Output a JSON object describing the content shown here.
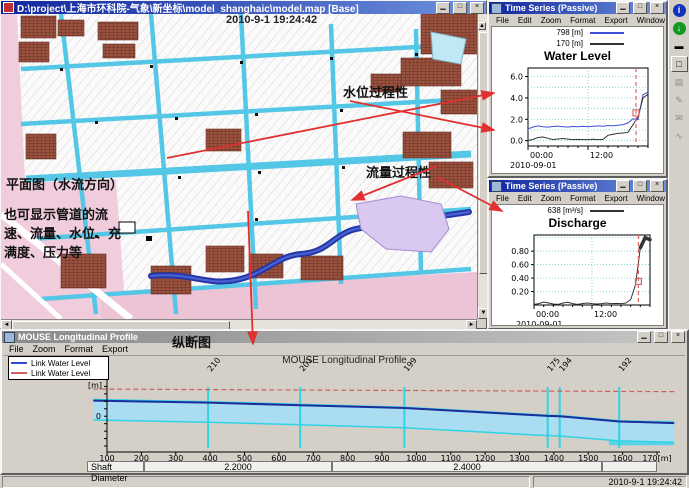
{
  "icons": {
    "minimize": "▁",
    "maximize": "□",
    "close": "×",
    "scroll_left": "◄",
    "scroll_right": "►",
    "scroll_up": "▲",
    "scroll_down": "▼",
    "info": "i",
    "ok": "↓",
    "dash": "▬",
    "window": "□",
    "page": "▤",
    "edit": "✎",
    "chat": "✉",
    "chart": "∿"
  },
  "map_window": {
    "title": "D:\\project\\上海市环科院-气象\\新坐标\\model_shanghaic\\model.map [Base]"
  },
  "overlay": {
    "timestamp": "2010-9-1 19:24:42",
    "water_level_label": "水位过程性",
    "discharge_label": "流量过程性",
    "plan_label": "平面图（水流方向）",
    "plan_note": "也可显示管道的流速、流量、水位、充满度、压力等",
    "profile_label": "纵断图"
  },
  "ts1": {
    "title": "Time Series (Passive)",
    "menu": [
      "File",
      "Edit",
      "Zoom",
      "Format",
      "Export",
      "Window"
    ]
  },
  "ts2": {
    "title": "Time Series (Passive)",
    "menu": [
      "File",
      "Edit",
      "Zoom",
      "Format",
      "Export",
      "Window"
    ]
  },
  "profile_window": {
    "title": "MOUSE Longitudinal Profile",
    "menu": [
      "File",
      "Zoom",
      "Format",
      "Export"
    ]
  },
  "status_bar": {
    "timestamp": "2010-9-1 19:24:42"
  },
  "chart_data": [
    {
      "id": "water_level",
      "type": "line",
      "title": "Water Level",
      "xlim": [
        0,
        24
      ],
      "ylim": [
        -0.5,
        6.8
      ],
      "x": [
        0,
        1,
        2,
        3,
        4,
        5,
        6,
        7,
        8,
        9,
        10,
        11,
        12,
        13,
        14,
        15,
        16,
        17,
        18,
        19,
        20,
        21,
        22,
        23,
        24
      ],
      "yticks": [
        0,
        2,
        4,
        6
      ],
      "ytick_labels": [
        "0.0",
        "2.0",
        "4.0",
        "6.0"
      ],
      "grid_y": [
        0,
        1,
        2,
        3,
        4,
        5,
        6
      ],
      "xticks": [
        0,
        12
      ],
      "xtick_labels": [
        "00:00",
        "12:00"
      ],
      "date_label": "2010-09-01",
      "series": [
        {
          "name": "798 [m]",
          "color": "#3b4fd8",
          "values": [
            1.1,
            1.28,
            1.38,
            1.3,
            1.27,
            1.33,
            1.36,
            1.3,
            1.28,
            1.32,
            1.3,
            1.34,
            1.3,
            1.35,
            1.38,
            1.35,
            1.42,
            1.38,
            1.44,
            1.5,
            1.65,
            2.05,
            1.95,
            4.3,
            4.55
          ]
        },
        {
          "name": "170 [m]",
          "color": "#333333",
          "values": [
            0.0,
            0.12,
            0.3,
            0.34,
            0.22,
            0.1,
            0.15,
            0.2,
            0.14,
            0.1,
            0.12,
            0.1,
            0.1,
            0.13,
            0.1,
            0.12,
            0.5,
            0.6,
            0.68,
            0.72,
            0.78,
            1.5,
            2.2,
            4.0,
            4.35
          ]
        }
      ],
      "cursor": {
        "x": 21.6,
        "marker_y": 2.6,
        "color": "#e06666"
      },
      "legend_position": "top"
    },
    {
      "id": "discharge",
      "type": "line",
      "title": "Discharge",
      "xlim": [
        0,
        24
      ],
      "ylim": [
        0,
        1.04
      ],
      "x": [
        0,
        1,
        2,
        3,
        4,
        5,
        6,
        7,
        8,
        9,
        10,
        11,
        12,
        13,
        14,
        15,
        16,
        17,
        18,
        19,
        20,
        21,
        22,
        23,
        24
      ],
      "yticks": [
        0.2,
        0.4,
        0.6,
        0.8
      ],
      "ytick_labels": [
        "0.20",
        "0.40",
        "0.60",
        "0.80"
      ],
      "grid_y": [
        0.2,
        0.4,
        0.6,
        0.8,
        1.0
      ],
      "xticks": [
        0,
        12
      ],
      "xtick_labels": [
        "00:00",
        "12:00"
      ],
      "date_label": "2010-09-01",
      "series": [
        {
          "name": "638 [m³/s]",
          "color": "#333333",
          "thick_from": 21.5,
          "values": [
            0.01,
            0.02,
            0.045,
            0.03,
            0.015,
            0.01,
            0.03,
            0.04,
            0.02,
            0.01,
            0.02,
            0.03,
            0.02,
            0.015,
            0.02,
            0.03,
            0.02,
            0.025,
            0.02,
            0.03,
            0.08,
            0.3,
            0.85,
            1.0,
            0.97
          ]
        }
      ],
      "cursor": {
        "x": 21.6,
        "marker_y": 0.35,
        "color": "#e06666"
      },
      "legend_position": "top"
    },
    {
      "id": "longitudinal_profile",
      "type": "profile",
      "title": "MOUSE Longitudinal Profile",
      "legend": [
        {
          "label": "Link Water Level",
          "color": "#2f4bd0"
        },
        {
          "label": "Link Water Level",
          "color": "#d06060"
        }
      ],
      "ylabel": "[m]",
      "ytick0": "0",
      "x_range": [
        100,
        1700
      ],
      "x_tick_labels": [
        "100",
        "200",
        "300",
        "400",
        "500",
        "600",
        "700",
        "800",
        "900",
        "1000",
        "1100",
        "1200",
        "1300",
        "1400",
        "1500",
        "1600",
        "170[m]"
      ],
      "ylim": [
        -4.8,
        5.4
      ],
      "nodes": [
        {
          "id": "210",
          "x": 394
        },
        {
          "id": "201",
          "x": 662
        },
        {
          "id": "199",
          "x": 965
        },
        {
          "id": "175",
          "x": 1382
        },
        {
          "id": "194",
          "x": 1417
        },
        {
          "id": "192",
          "x": 1590
        }
      ],
      "ground": [
        [
          60,
          3.65
        ],
        [
          500,
          3.55
        ],
        [
          1000,
          3.45
        ],
        [
          1750,
          3.3
        ]
      ],
      "pipe_top": [
        [
          60,
          2.25
        ],
        [
          394,
          1.95
        ],
        [
          662,
          1.6
        ],
        [
          965,
          1.2
        ],
        [
          1382,
          0.15
        ],
        [
          1417,
          0.1
        ],
        [
          1590,
          -0.6
        ],
        [
          1750,
          -0.85
        ]
      ],
      "pipe_bottom": [
        [
          60,
          -0.5
        ],
        [
          394,
          -0.8
        ],
        [
          662,
          -1.15
        ],
        [
          965,
          -1.55
        ],
        [
          1382,
          -2.6
        ],
        [
          1417,
          -2.65
        ],
        [
          1590,
          -3.3
        ],
        [
          1750,
          -3.5
        ]
      ],
      "water_level": [
        [
          60,
          2.1
        ],
        [
          394,
          1.82
        ],
        [
          662,
          1.48
        ],
        [
          965,
          1.1
        ],
        [
          1382,
          0.05
        ],
        [
          1417,
          0.0
        ],
        [
          1590,
          -0.7
        ],
        [
          1750,
          -0.92
        ]
      ],
      "outlet": {
        "x0": 1560,
        "x1": 1750,
        "top": -0.6,
        "bottom": -3.9
      },
      "shaft": {
        "label": "Shaft Diameter",
        "values": [
          "2.2000",
          "2.4000"
        ]
      }
    }
  ]
}
